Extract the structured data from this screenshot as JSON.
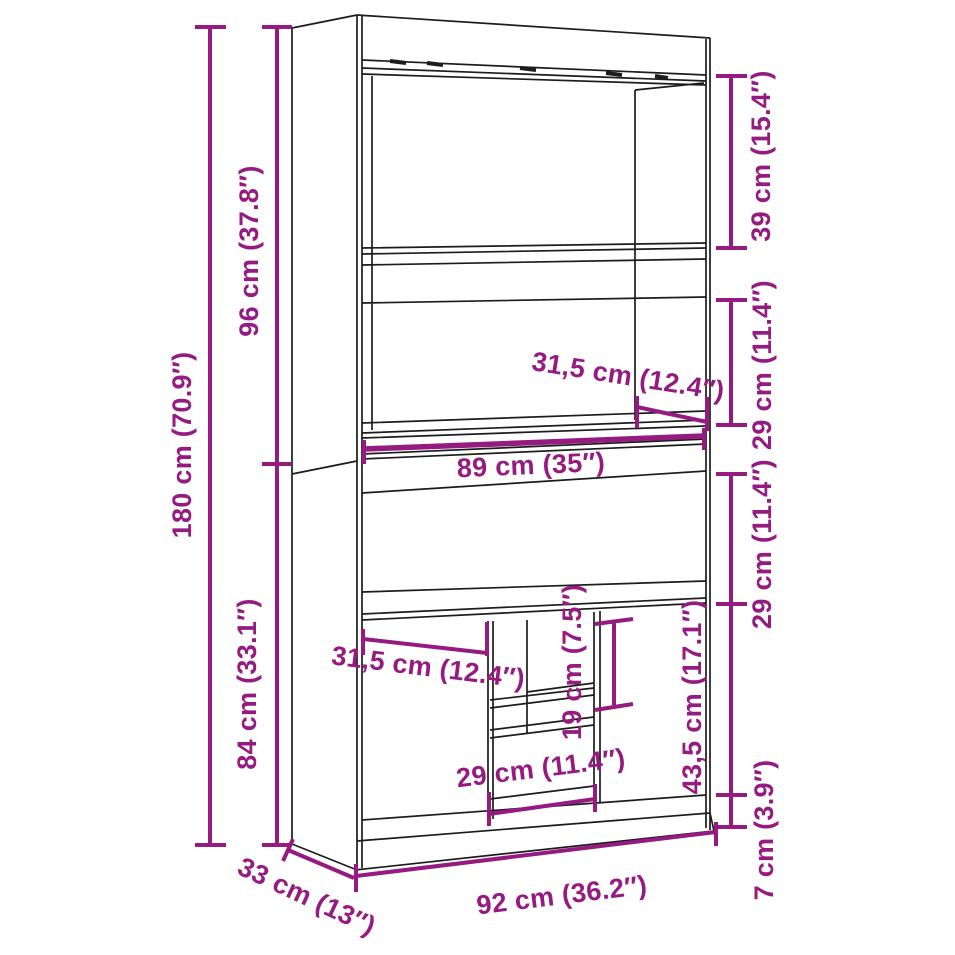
{
  "diagram": {
    "kind": "furniture-dimension-line-drawing",
    "subject": "highboard cabinet with open shelves and doors",
    "colors": {
      "dimension_annotations": "#951b81",
      "drawing_outline": "#1c1c1c",
      "background": "#ffffff"
    },
    "units": {
      "primary": "cm",
      "secondary": "inches"
    }
  },
  "dimensions": {
    "overall_height": {
      "label": "180 cm (70.9″)",
      "cm": 180,
      "inches": 70.9
    },
    "upper_section_height": {
      "label": "96 cm (37.8″)",
      "cm": 96,
      "inches": 37.8
    },
    "lower_section_height": {
      "label": "84 cm (33.1″)",
      "cm": 84,
      "inches": 33.1
    },
    "top_compartment_height": {
      "label": "39 cm (15.4″)",
      "cm": 39,
      "inches": 15.4
    },
    "shelf_compartment_height": {
      "label": "29 cm (11.4″)",
      "cm": 29,
      "inches": 11.4
    },
    "worktop_interior_depth": {
      "label": "31,5 cm (12.4″)",
      "cm": 31.5,
      "inches": 12.4
    },
    "worktop_width": {
      "label": "89 cm (35″)",
      "cm": 89,
      "inches": 35
    },
    "niche_height": {
      "label": "29 cm (11.4″)",
      "cm": 29,
      "inches": 11.4
    },
    "door_width": {
      "label": "31,5 cm (12.4″)",
      "cm": 31.5,
      "inches": 12.4
    },
    "shelf_spacing": {
      "label": "19 cm (7.5″)",
      "cm": 19,
      "inches": 7.5
    },
    "door_height": {
      "label": "43,5 cm (17.1″)",
      "cm": 43.5,
      "inches": 17.1
    },
    "middle_compartment_width": {
      "label": "29 cm (11.4″)",
      "cm": 29,
      "inches": 11.4
    },
    "plinth_height": {
      "label": "7 cm (3.9″)",
      "cm": 7,
      "inches": 3.9
    },
    "overall_width": {
      "label": "92 cm (36.2″)",
      "cm": 92,
      "inches": 36.2
    },
    "overall_depth": {
      "label": "33 cm (13″)",
      "cm": 33,
      "inches": 13
    }
  }
}
